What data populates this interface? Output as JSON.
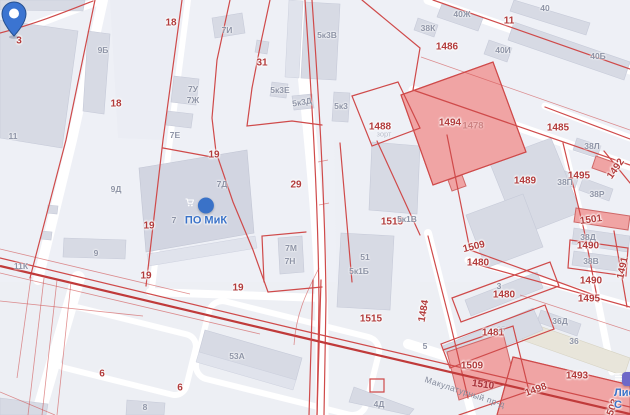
{
  "street": "Макулатурный пр-д",
  "pin": {
    "type": "map-pin",
    "parcel": "29"
  },
  "poi": [
    {
      "label": "ПО МиК",
      "icon": "shopping-cart"
    },
    {
      "label": "Лист-С",
      "icon": "list"
    }
  ],
  "labels": {
    "red": [
      "3",
      "18",
      "18",
      "31",
      "11",
      "1486",
      "1488",
      "1494",
      "1478",
      "1485",
      "1489",
      "1495",
      "1492",
      "1515",
      "1515",
      "19",
      "19",
      "19",
      "19",
      "29",
      "1501",
      "1490",
      "1490",
      "1495",
      "1491",
      "1509",
      "1480",
      "1480",
      "1481",
      "1484",
      "1509",
      "1510",
      "1493",
      "1498",
      "6",
      "6",
      "1503"
    ],
    "gray": [
      "9Б",
      "7И",
      "5к3В",
      "7У",
      "7Ж",
      "5к3Е",
      "5к3Д",
      "5к3",
      "7Е",
      "11",
      "38К",
      "40Ж",
      "40",
      "40И",
      "40Б",
      "38Л",
      "38П",
      "38Р",
      "38Д",
      "38В",
      "9Д",
      "7Д",
      "7",
      "9",
      "11К",
      "7М",
      "7Н",
      "5к1В",
      "51",
      "5к1Б",
      "53А",
      "4Д",
      "3",
      "25",
      "5",
      "36Д",
      "36",
      "8",
      "зорт"
    ]
  },
  "colors": {
    "background": "#eef0f6",
    "road": "#ffffff",
    "building": "#d7dae4",
    "building_dark": "#d2d5e1",
    "building_pink": "#f0a4a4",
    "building_pink_border": "#cf6868",
    "beige_building": "#e8e5da",
    "cadastral_line": "#cf4a4a",
    "cadastral_line_thick": "#c03a3a",
    "red_label": "#b23b3b",
    "red_label_light": "#cd8383",
    "gray_label": "#8e94a6",
    "blue_poi": "#3a72c8",
    "street_label": "#858b9c",
    "pin_fill": "#3b74d1",
    "pin_border": "#27508f"
  }
}
